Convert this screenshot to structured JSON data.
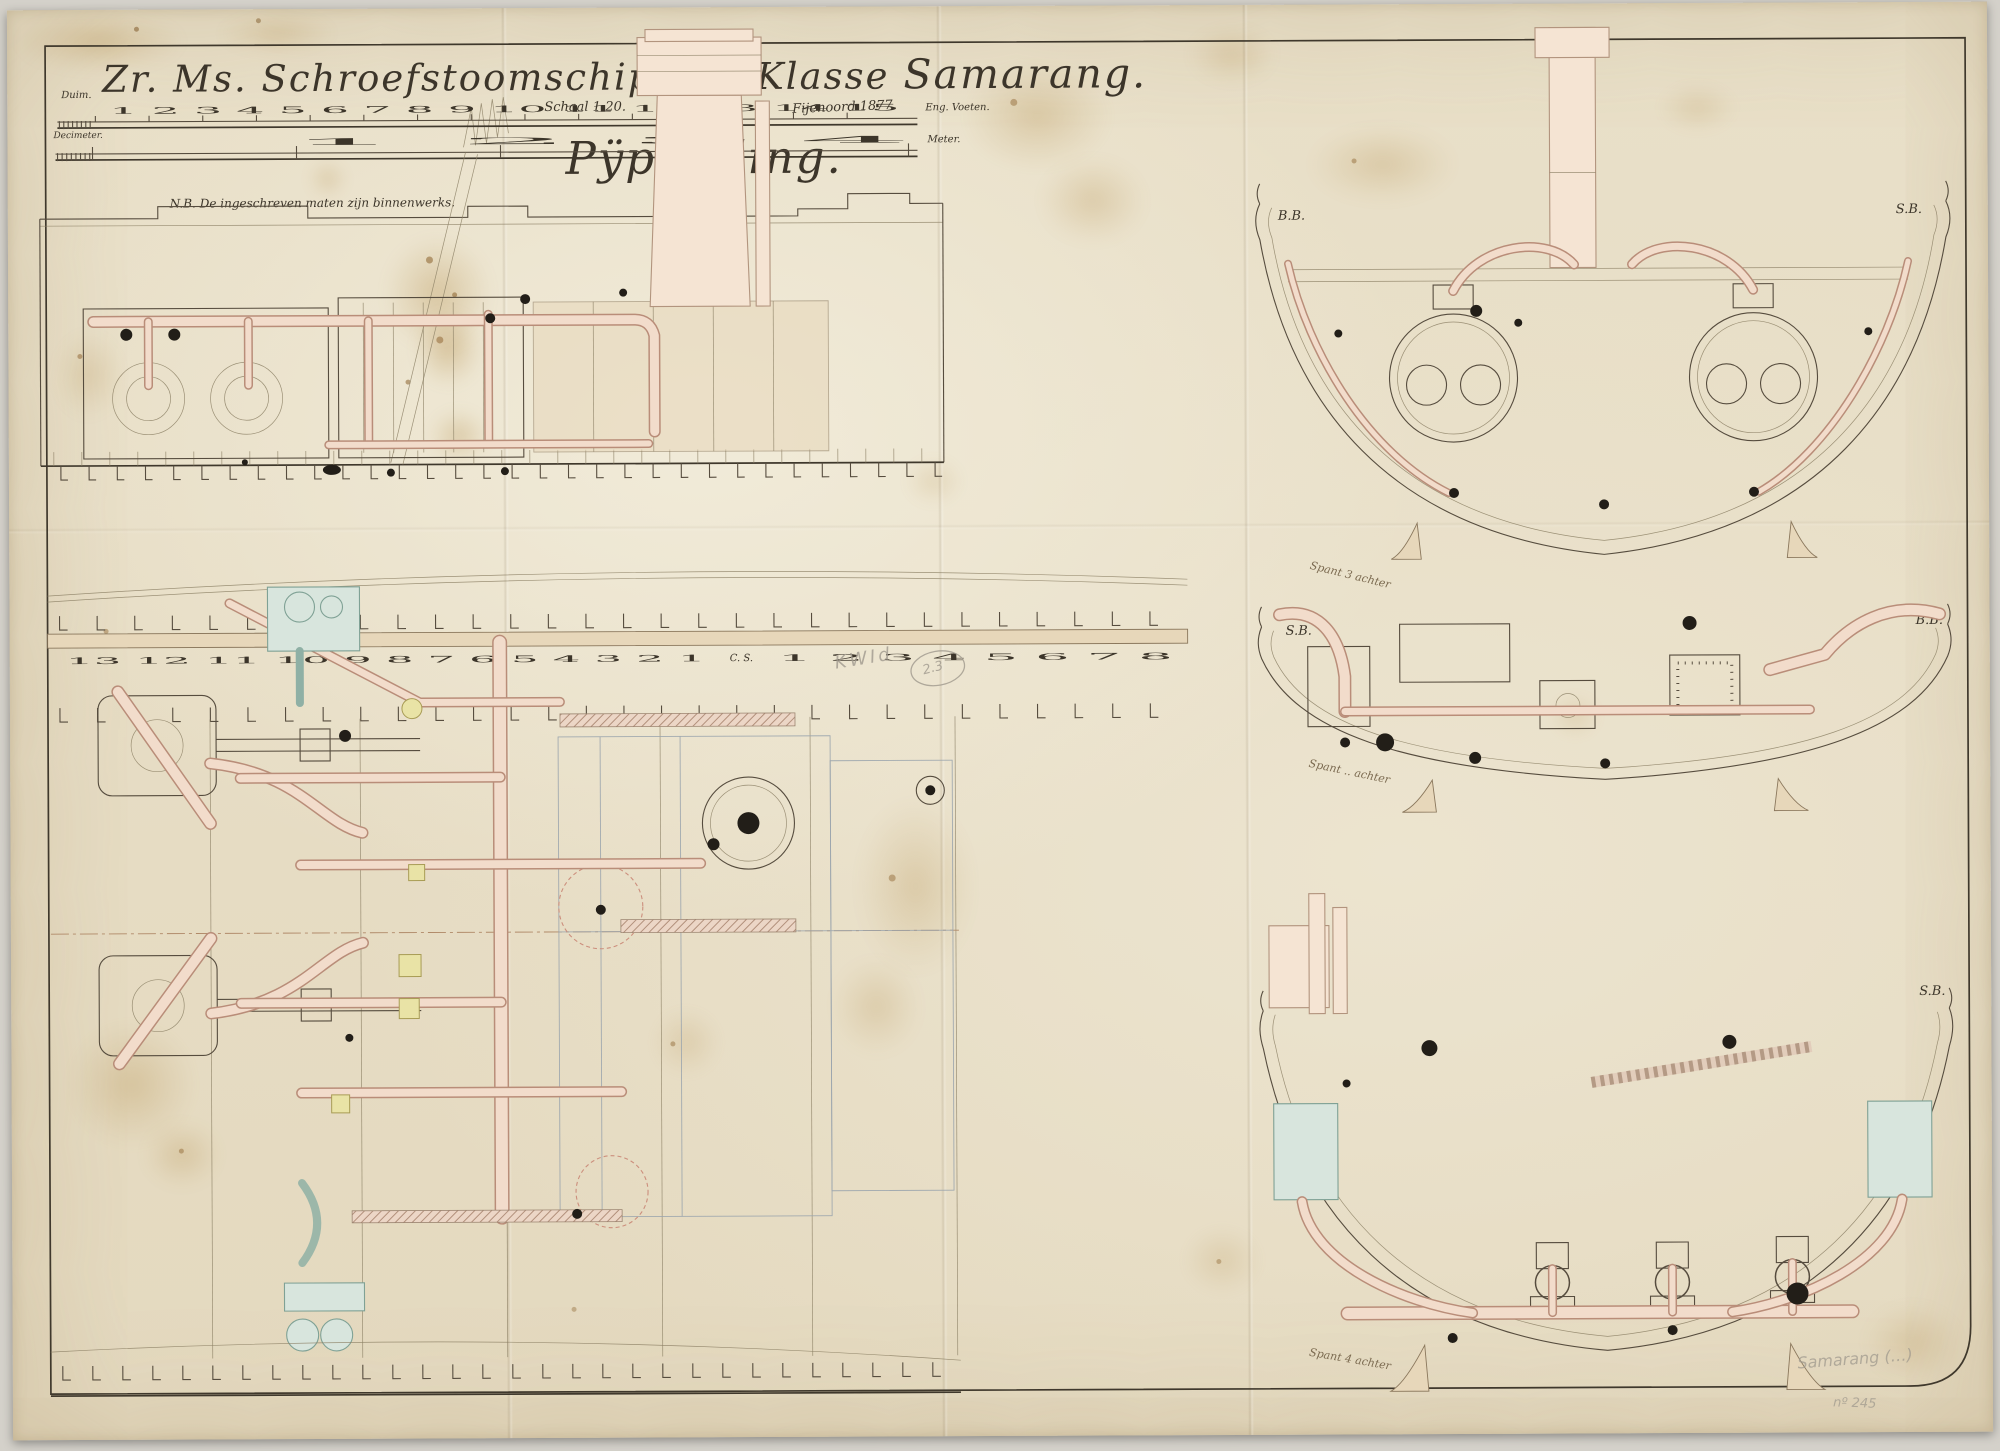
{
  "palette": {
    "paper": "#e9e0c9",
    "ink": "#564c3e",
    "pipe_pink": "#f2dccb",
    "pipe_edge": "#b98d79",
    "teal": "#7fa195",
    "accent_yellow": "#e9e3a6",
    "pencil": "#a09a8e"
  },
  "title": {
    "line": "Zr. Ms. Schroefstoomschip 4de Klasse",
    "ship": "Samarang.",
    "subtitle": "Pÿpleiding."
  },
  "scales": {
    "duim_label": "Duim.",
    "duim_numbers": "1 2 3 4 5 6 7 8 9 10 11 12 13 14 15",
    "duim_unit": "Eng. Voeten.",
    "decimeter_label": "Decimeter.",
    "meter_numbers": "1 2 3 4",
    "meter_unit": "Meter.",
    "schaal": "Schaal 1:20.",
    "signature": "Fijenoord 1877.",
    "note": "N.B. De ingeschreven maten zijn binnenwerks."
  },
  "stations": {
    "left": "13 12 11 10 9 8 7 6 5 4 3 2 1",
    "center": "C. S.",
    "right": "1 2 3 4 5 6 7 8"
  },
  "sections": {
    "aft": {
      "left_label": "B.B.",
      "right_label": "S.B.",
      "caption": "Spant 3 achter"
    },
    "mid": {
      "left_label": "S.B.",
      "right_label": "B.B.",
      "caption": "Spant .. achter"
    },
    "fore": {
      "left_label": "B.B.",
      "right_label": "S.B.",
      "caption": "Spant 4 achter"
    }
  },
  "stamps": {
    "kwid": "KWId",
    "kwid_no": "2.3",
    "pencil_name": "Samarang (…)",
    "pencil_no": "nº 245"
  }
}
